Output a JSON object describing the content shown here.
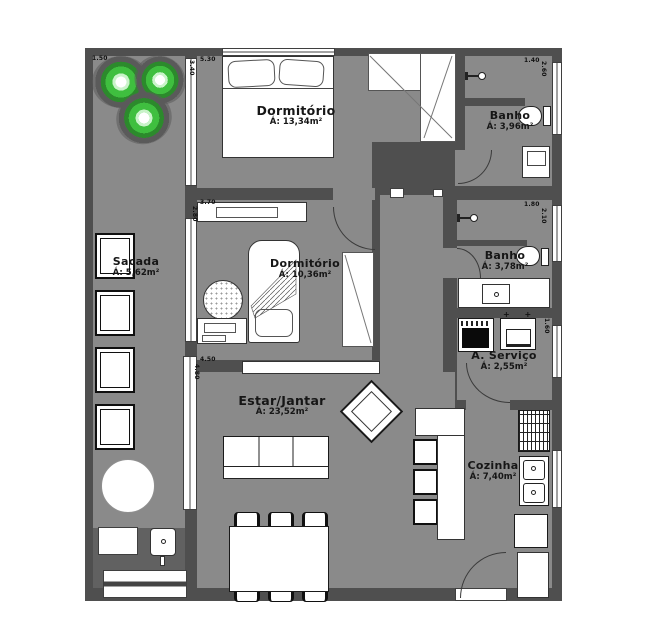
{
  "plan_title": "apartment-floor-plan",
  "rooms": {
    "dorm1": {
      "name": "Dormitório",
      "area": "Á: 13,34m²"
    },
    "banho1": {
      "name": "Banho",
      "area": "Á: 3,96m²"
    },
    "dorm2": {
      "name": "Dormitório",
      "area": "Á: 10,36m²"
    },
    "banho2": {
      "name": "Banho",
      "area": "Á: 3,78m²"
    },
    "sacada": {
      "name": "Sacada",
      "area": "Á: 5,62m²"
    },
    "servico": {
      "name": "A. Serviço",
      "area": "Á: 2,55m²"
    },
    "estar": {
      "name": "Estar/Jantar",
      "area": "Á: 23,52m²"
    },
    "cozinha": {
      "name": "Cozinha",
      "area": "Á: 7,40m²"
    }
  },
  "dimensions": {
    "sacada_top": "1.50",
    "dorm1_top": "5.30",
    "dorm1_side": "3.40",
    "banho1_top": "1.40",
    "banho1_side": "2.60",
    "dorm2_top": "3.70",
    "dorm2_side": "2.80",
    "banho2_top": "1.80",
    "banho2_side": "2.10",
    "servico_side": "1.60",
    "estar_top": "4.50",
    "estar_side": "4.80"
  },
  "symbols": {
    "servico_taps": "+ +"
  },
  "colors": {
    "wall": "#4f4f4f",
    "floor": "#8a8a8a",
    "furniture": "#ffffff",
    "plant_green": "#3fbf3f",
    "background": "#ffffff"
  }
}
